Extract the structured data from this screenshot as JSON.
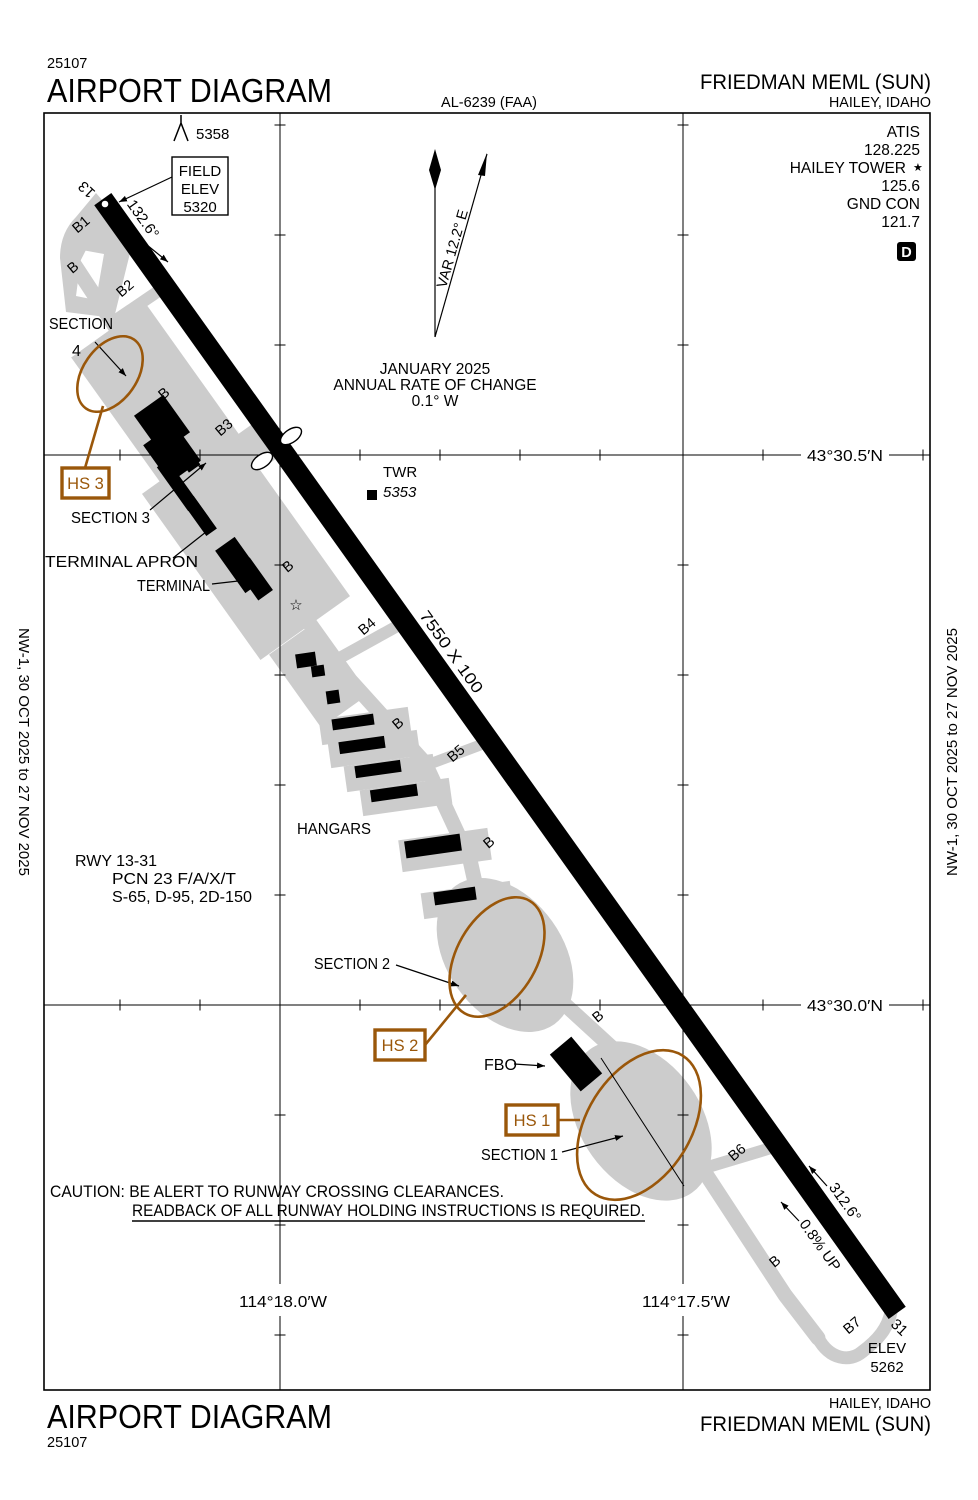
{
  "page": {
    "chart_code": "25107",
    "title": "AIRPORT DIAGRAM",
    "al_number": "AL-6239 (FAA)",
    "airport_name": "FRIEDMAN MEML (SUN)",
    "city": "HAILEY, IDAHO",
    "effective_dates": "NW-1,  30 OCT 2025  to  27 NOV 2025"
  },
  "comm": {
    "atis_label": "ATIS",
    "atis_freq": "128.225",
    "tower_label": "HAILEY TOWER",
    "tower_star": "★",
    "tower_freq": "125.6",
    "ground_label": "GND CON",
    "ground_freq": "121.7",
    "data_box": "D"
  },
  "north": {
    "variation": "VAR 12.2° E",
    "date": "JANUARY 2025",
    "rate_label": "ANNUAL RATE OF CHANGE",
    "rate_value": "0.1° W"
  },
  "field": {
    "elev_label1": "FIELD",
    "elev_label2": "ELEV",
    "elev_value": "5320",
    "obstruction_elev": "5358"
  },
  "tower_site": {
    "label": "TWR",
    "elev": "5353"
  },
  "runway": {
    "number_13": "13",
    "number_31": "31",
    "heading_13": "132.6°",
    "heading_31": "312.6°",
    "dimensions": "7550 X 100",
    "gradient": "0.8% UP",
    "end31_elev_label": "ELEV",
    "end31_elev": "5262",
    "data_line1": "RWY 13-31",
    "data_line2": "PCN 23 F/A/X/T",
    "data_line3": "S-65, D-95, 2D-150"
  },
  "areas": {
    "section4_line1": "SECTION",
    "section4_line2": "4",
    "section3": "SECTION 3",
    "terminal_apron": "TERMINAL APRON",
    "terminal": "TERMINAL",
    "hangars": "HANGARS",
    "section2": "SECTION 2",
    "section1": "SECTION 1",
    "fbo": "FBO"
  },
  "hotspots": {
    "hs1": "HS 1",
    "hs2": "HS 2",
    "hs3": "HS 3"
  },
  "caution": {
    "line1": "CAUTION: BE ALERT TO RUNWAY CROSSING CLEARANCES.",
    "line2": "READBACK OF ALL RUNWAY HOLDING INSTRUCTIONS IS REQUIRED."
  },
  "coordinates": {
    "lat_north": "43°30.5′N",
    "lat_south": "43°30.0′N",
    "lon_west": "114°18.0′W",
    "lon_east": "114°17.5′W"
  },
  "taxiways": [
    "B1",
    "B",
    "B2",
    "B",
    "B3",
    "B",
    "B4",
    "B",
    "B5",
    "B",
    "B",
    "B6",
    "B",
    "B7"
  ],
  "symbols": {
    "star": "☆"
  },
  "colors": {
    "hotspot": "#9a570a",
    "pavement": "#cccccc"
  }
}
